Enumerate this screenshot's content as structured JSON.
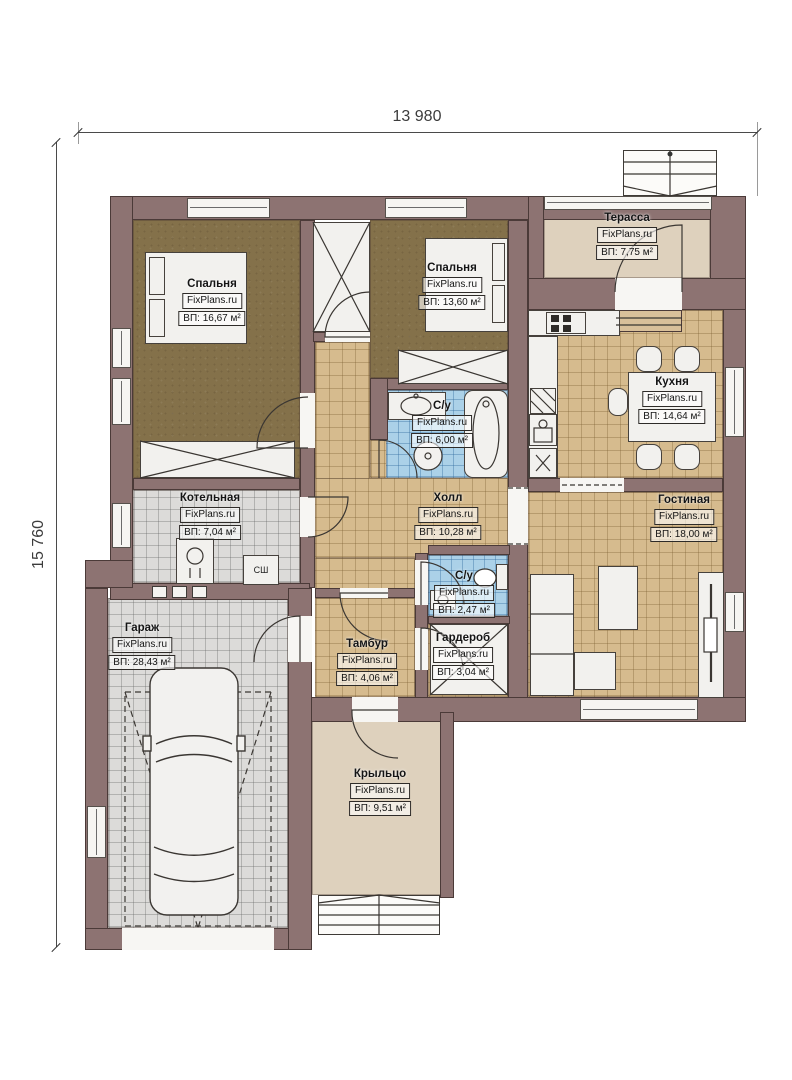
{
  "dimensions": {
    "width": "13 980",
    "height": "15 760"
  },
  "watermark": "FixPlans.ru",
  "rooms": [
    {
      "name": "Спальня",
      "area": "ВП: 16,67 м²"
    },
    {
      "name": "Спальня",
      "area": "ВП: 13,60 м²"
    },
    {
      "name": "Терасса",
      "area": "ВП: 7,75 м²"
    },
    {
      "name": "Кухня",
      "area": "ВП: 14,64 м²"
    },
    {
      "name": "Гостиная",
      "area": "ВП: 18,00 м²"
    },
    {
      "name": "Котельная",
      "area": "ВП: 7,04 м²"
    },
    {
      "name": "Холл",
      "area": "ВП: 10,28 м²"
    },
    {
      "name": "С/у",
      "area": "ВП: 6,00 м²"
    },
    {
      "name": "С/у",
      "area": "ВП: 2,47 м²"
    },
    {
      "name": "Тамбур",
      "area": "ВП: 4,06 м²"
    },
    {
      "name": "Гардероб",
      "area": "ВП: 3,04 м²"
    },
    {
      "name": "Гараж",
      "area": "ВП: 28,43 м²"
    },
    {
      "name": "Крыльцо",
      "area": "ВП: 9,51 м²"
    }
  ],
  "annotations": {
    "dryer_cabinet": "СШ"
  },
  "palette": {
    "wall": "#8d7372",
    "bedroom_floor": "#84714a",
    "tile_tan": "#d6bb8e",
    "tile_blue": "#abd1e8",
    "tile_gray": "#dcdbd9",
    "terrace_beige": "#ded1bd"
  }
}
